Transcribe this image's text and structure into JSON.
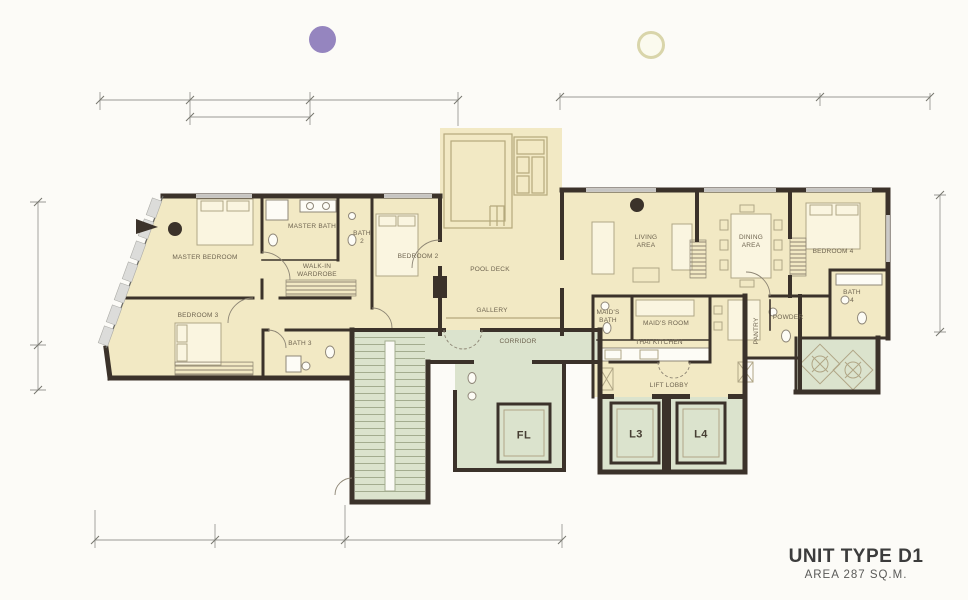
{
  "title_block": {
    "unit_type": "UNIT TYPE D1",
    "area": "AREA 287 SQ.M."
  },
  "colors": {
    "cream": "#f2e9c4",
    "green": "#dbe3cd",
    "wall": "#3b322a",
    "furn": "#b0a686",
    "fixline": "#8f8778",
    "dim": "#9a9a95",
    "labelc": "#6e6450",
    "purple": "#9585bf",
    "dotfill": "#fbfaee",
    "dotring": "#d9d5aa",
    "poolline": "#b5a97c",
    "titlec": "#3c3c3c",
    "bg": "#fcfbf7"
  },
  "legend": {
    "purple_dot_color": "#9585bf",
    "cream_dot_color": "#fbfaee"
  },
  "rooms": [
    {
      "id": "master-bedroom",
      "label": "MASTER BEDROOM",
      "x": 205,
      "y": 258
    },
    {
      "id": "master-bath",
      "label": "MASTER BATH",
      "x": 312,
      "y": 227
    },
    {
      "id": "bath-2",
      "label": "BATH 2",
      "x": 362,
      "y": 238,
      "w": 20,
      "wrap": true
    },
    {
      "id": "walk-in-wardrobe",
      "label": "WALK-IN WARDROBE",
      "x": 317,
      "y": 271,
      "w": 50,
      "wrap": true
    },
    {
      "id": "bedroom-2",
      "label": "BEDROOM 2",
      "x": 418,
      "y": 257
    },
    {
      "id": "pool-deck",
      "label": "POOL DECK",
      "x": 490,
      "y": 270
    },
    {
      "id": "bedroom-3",
      "label": "BEDROOM 3",
      "x": 198,
      "y": 316
    },
    {
      "id": "bath-3",
      "label": "BATH 3",
      "x": 300,
      "y": 344
    },
    {
      "id": "gallery",
      "label": "GALLERY",
      "x": 492,
      "y": 311
    },
    {
      "id": "corridor",
      "label": "CORRIDOR",
      "x": 518,
      "y": 342
    },
    {
      "id": "living-area",
      "label": "LIVING AREA",
      "x": 646,
      "y": 242,
      "w": 34,
      "wrap": true
    },
    {
      "id": "dining-area",
      "label": "DINING AREA",
      "x": 751,
      "y": 242,
      "w": 34,
      "wrap": true
    },
    {
      "id": "bedroom-4",
      "label": "BEDROOM 4",
      "x": 833,
      "y": 252
    },
    {
      "id": "bath-4",
      "label": "BATH 4",
      "x": 852,
      "y": 297,
      "w": 20,
      "wrap": true
    },
    {
      "id": "powder",
      "label": "POWDER",
      "x": 788,
      "y": 318
    },
    {
      "id": "pantry",
      "label": "PANTRY",
      "x": 757,
      "y": 331,
      "rot": -90
    },
    {
      "id": "maids-bath",
      "label": "MAID'S BATH",
      "x": 608,
      "y": 317,
      "w": 30,
      "wrap": true
    },
    {
      "id": "maids-room",
      "label": "MAID'S ROOM",
      "x": 666,
      "y": 324
    },
    {
      "id": "thai-kitchen",
      "label": "THAI KITCHEN",
      "x": 659,
      "y": 343
    },
    {
      "id": "lift-lobby",
      "label": "LIFT LOBBY",
      "x": 669,
      "y": 386
    },
    {
      "id": "lift-fl",
      "label": "FL",
      "x": 524,
      "y": 436,
      "cls": "lift"
    },
    {
      "id": "lift-l3",
      "label": "L3",
      "x": 636,
      "y": 435,
      "cls": "lift"
    },
    {
      "id": "lift-l4",
      "label": "L4",
      "x": 701,
      "y": 435,
      "cls": "lift"
    }
  ]
}
